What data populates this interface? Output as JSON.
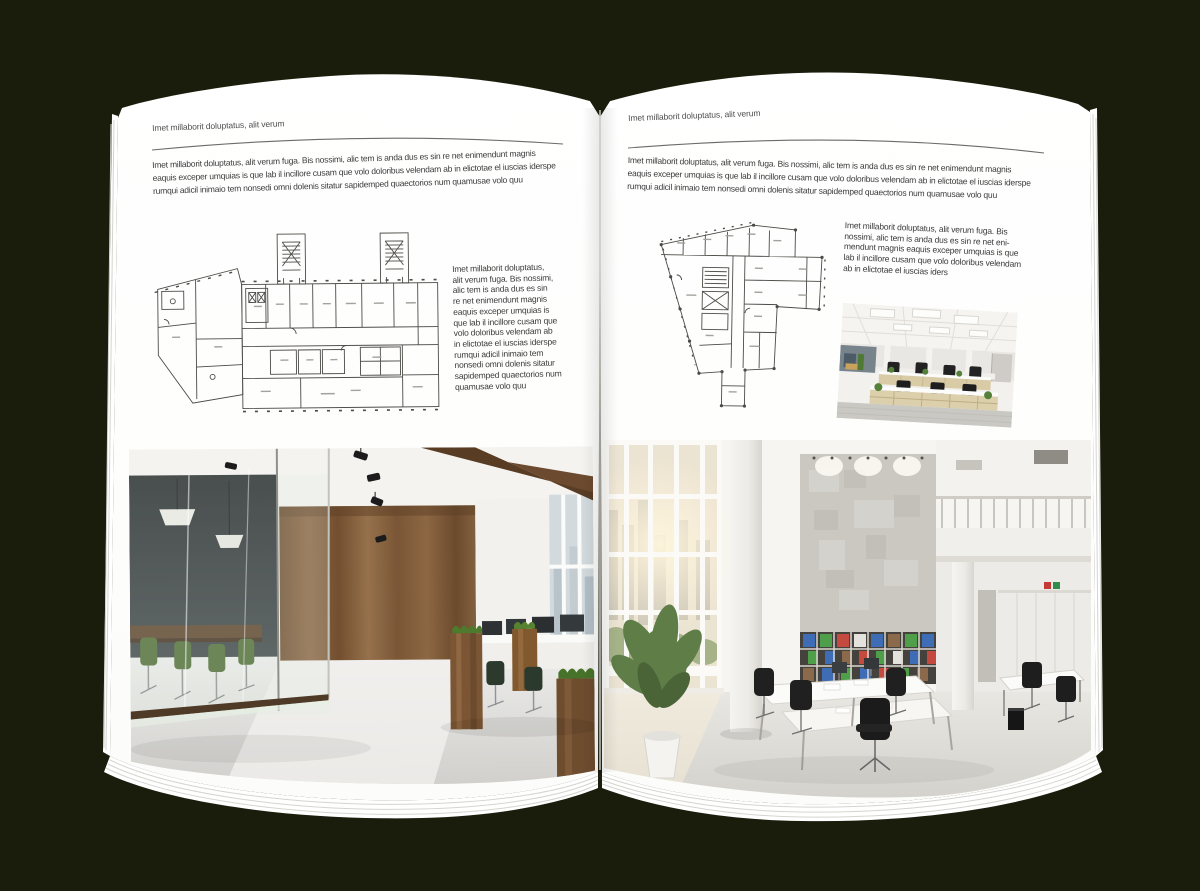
{
  "colors": {
    "backdrop": "#1b1d0c",
    "paper": "#ffffff",
    "rule_line": "#6b6b6b",
    "plan_line": "#4c4b46",
    "accent_wood": "#7c5634",
    "accent_green_chair": "#4c6a33",
    "binder_blue": "#3f6db5",
    "binder_green": "#4f9e49",
    "binder_red": "#c4493e"
  },
  "left_page": {
    "header": "Imet millaborit doluptatus, alit verum",
    "intro": "Imet millaborit doluptatus, alit verum fuga. Bis nossimi, alic tem is anda dus es sin re net enimendunt magnis\neaquis exceper umquias is que lab il incillore cusam que volo doloribus velendam ab in elictotae el iuscias iderspe\nrumqui adicil inimaio tem nonsedi omni dolenis sitatur sapidemped quaectorios num quamusae volo quu",
    "caption": "Imet millaborit doluptatus,\nalit verum fuga. Bis nossimi,\nalic tem is anda dus es sin\nre net enimendunt magnis\neaquis exceper umquias is\nque lab il incillore cusam que\nvolo doloribus velendam ab\nin elictotae el iuscias iderspe\nrumqui adicil inimaio tem\nnonsedi omni dolenis sitatur\nsapidemped quaectorios num\nquamusae volo quu",
    "figures": {
      "floor_plan": "architectural floor plan drawing, wide building with two stair towers and angled left wing",
      "photo": "office interior photo: glass meeting room with green chairs, wood plank wall, white floor, desks with monitors"
    }
  },
  "right_page": {
    "header": "Imet millaborit doluptatus, alit verum",
    "intro": "Imet millaborit doluptatus, alit verum fuga. Bis nossimi, alic tem is anda dus es sin re net enimendunt magnis\neaquis exceper umquias is que lab il incillore cusam que volo doloribus velendam ab in elictotae el iuscias iderspe\nrumqui adicil inimaio tem nonsedi omni dolenis sitatur sapidemped quaectorios num quamusae volo quu",
    "caption": "Imet millaborit doluptatus, alit verum fuga. Bis\nnossimi, alic tem is anda dus es sin re net eni-\nmendunt magnis eaquis exceper umquias is que\nlab il incillore cusam que volo doloribus velendam\nab in elictotae el iuscias iders",
    "figures": {
      "floor_plan": "architectural floor plan drawing, irregular building with angled left edge and bottom stem",
      "photo_small": "office interior photo: bright open office, rows of desks with beige cabinets and black chairs",
      "photo_large": "office interior photo: tall white atrium, window wall with sunlight, concrete panel, shelf with colorful binders, white desks, black chairs, potted plant"
    }
  }
}
